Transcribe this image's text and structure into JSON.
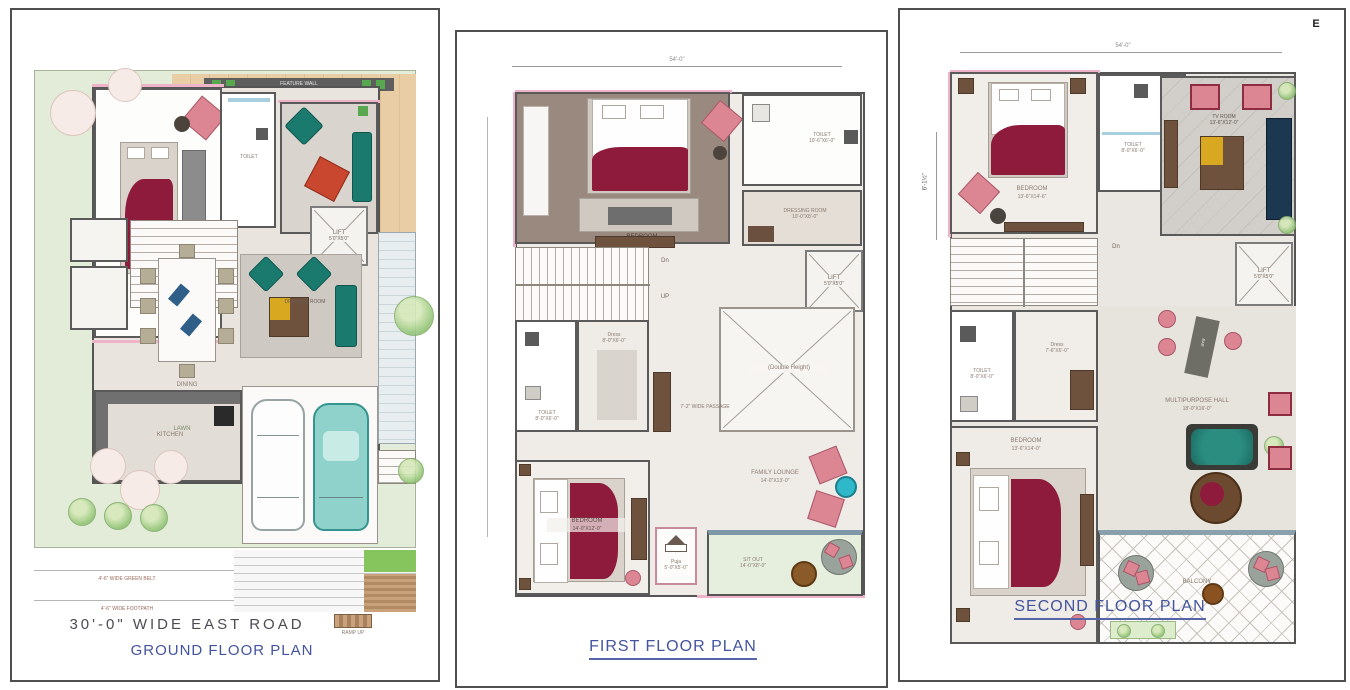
{
  "colors": {
    "title_blue": "#44549e",
    "wall_gray": "#5a5a5a",
    "accent_pink": "#eeb3c8",
    "lawn_green": "#e3ecd9",
    "deck_wood": "#e9cda4",
    "bed_red": "#8e1a3c",
    "sofa_teal": "#1a7a6e",
    "car_teal": "#8fd2cb"
  },
  "ground": {
    "title": "GROUND FLOOR PLAN",
    "road_label": "30'-0\"  WIDE  EAST  ROAD",
    "ramp_label": "RAMP UP",
    "greenbelt_label": "4'-6\" WIDE GREEN BELT",
    "footpath_label": "4'-6\" WIDE FOOTPATH",
    "deck_label": "DECK",
    "feature_wall_label": "FEATURE WALL",
    "bedroom_label": "BEDROOM",
    "toilet_label": "TOILET",
    "lift_name": "LIFT",
    "lift_dim": "5'0\"X5'0\"",
    "dining_label": "DINING",
    "drawing_label": "DRAWING ROOM",
    "kitchen_label": "KITCHEN",
    "lawn_label": "LAWN"
  },
  "first": {
    "title": "FIRST FLOOR PLAN",
    "top_dim": "54'-0\"",
    "bedroom1_name": "BEDROOM",
    "bedroom1_dim": "15'-0\"X14'-0\"",
    "toilet1_name": "TOILET",
    "toilet1_dim": "10'-6\"X6'-0\"",
    "dressing_name": "DRESSING ROOM",
    "dressing_dim": "10'-0\"X8'-0\"",
    "dn": "Dn",
    "up": "UP",
    "lift_name": "LIFT",
    "lift_dim": "5'0\"X5'0\"",
    "double_height": "(Double Height)",
    "toilet2_name": "TOILET",
    "toilet2_dim": "8'-0\"X6'-0\"",
    "dress_name": "Dress",
    "dress_dim": "8'-0\"X6'-0\"",
    "passage": "7'-2\" WIDE PASSAGE",
    "bedroom2_name": "BEDROOM",
    "bedroom2_dim": "14'-0\"X12'-0\"",
    "lounge_name": "FAMILY LOUNGE",
    "lounge_dim": "14'-0\"X13'-0\"",
    "puja_name": "Puja",
    "puja_dim": "5'-0\"X5'-0\"",
    "sitout_name": "SIT OUT",
    "sitout_dim": "14'-0\"X8'-0\""
  },
  "second": {
    "title": "SECOND FLOOR PLAN",
    "compass": "E",
    "top_dim": "54'-0\"",
    "left_dim": "6'-1½\"",
    "bedroom_name": "BEDROOM",
    "bedroom_dim": "13'-6\"X14'-6\"",
    "toilet1_name": "TOILET",
    "toilet1_dim": "8'-0\"X6'-0\"",
    "tvroom_name": "TV ROOM",
    "tvroom_dim": "13'-6\"X12'-0\"",
    "dn": "Dn",
    "lift_name": "LIFT",
    "lift_dim": "5'0\"X5'0\"",
    "toilet2_name": "TOILET",
    "toilet2_dim": "8'-0\"X6'-0\"",
    "dress_name": "Dress",
    "dress_dim": "7'-6\"X6'-0\"",
    "hall_name": "MULTIPURPOSE HALL",
    "hall_dim": "18'-0\"X16'-0\"",
    "bar_label": "BAR",
    "guest_name": "BEDROOM",
    "guest_dim": "13'-6\"X14'-0\"",
    "balcony_label": "BALCONY"
  }
}
